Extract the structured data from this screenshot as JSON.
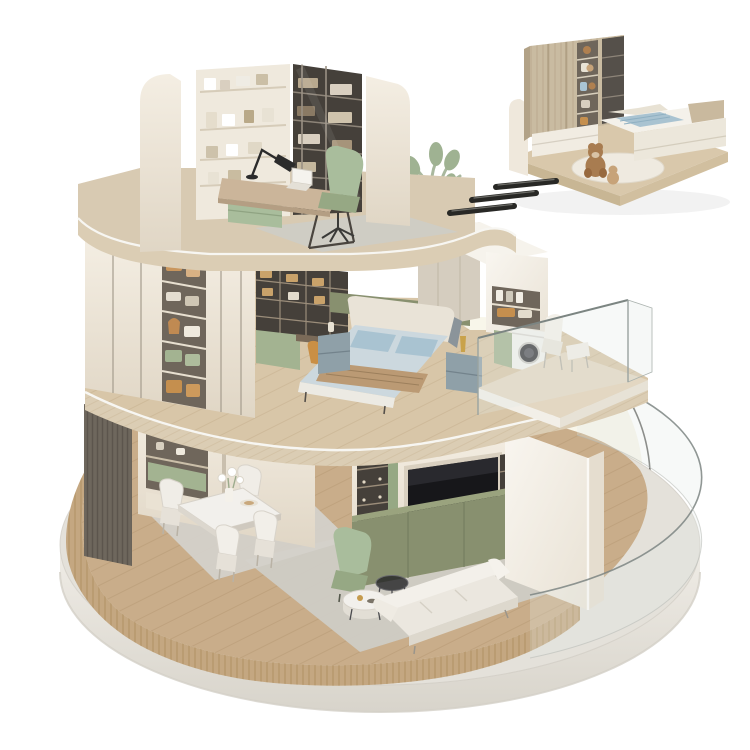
{
  "scene": {
    "type": "isometric-cutaway-render",
    "description": "Three-storey apartment cutaway standing on a round stone base, with a detached kids-bedroom detail block floating at the top right and three motion dashes linking it to the building",
    "background": "#ffffff"
  },
  "palette": {
    "stone_top": "#e4e1da",
    "stone_side": "#edeae4",
    "stone_rim": "#d3cfc7",
    "wood_floor": "#c9ad8a",
    "wood_plinth": "#c4a781",
    "travertine": "#dbcdb4",
    "trim_white": "#f7f6f2",
    "wall_cream": "#f0e9dd",
    "wall_cream_shade": "#e1d7c7",
    "wall_white": "#f6f2ec",
    "wardrobe_door": "#ece4d6",
    "recess_dark": "#6f665b",
    "shelf_dark": "#45403a",
    "bronze": "#9b8d7a",
    "olive": "#88906f",
    "olive_top": "#9aa37e",
    "sage": "#a9bd9c",
    "sage_dark": "#96a884",
    "green_cabinet": "#a3b391",
    "bed_duvet": "#ccd8de",
    "bed_pillow": "#a9c3d1",
    "throw_tan": "#bb9a74",
    "headboard_cream": "#e9e3d7",
    "slate": "#8b949a",
    "rug_gray": "#cfccc5",
    "rug_warm": "#d4d1ca",
    "tv_black": "#17171a",
    "dark_slat": "#6e675d",
    "glass_line": "#7c8582",
    "glass_fill": "rgba(225,232,230,0.28)",
    "dome": "#f8f6ea",
    "dome_edge": "#3a3a36",
    "arrow": "#282825",
    "inset_base": "#d9c8ab",
    "inset_wardrobe": "#c9bba1",
    "teddy": "#a87c50",
    "tan_chair": "#c98f45",
    "nightstand": "#8fa0a8",
    "marble_table": "#f2f0ec"
  },
  "structure": {
    "platform": {
      "name": "round-stone-base"
    },
    "floors": [
      {
        "id": "ground",
        "rooms": [
          {
            "name": "dining-area",
            "items": [
              "curved-slat-wall",
              "dark-slat-panel",
              "display-cabinet",
              "dining-table",
              "dining-chairs",
              "flower-vase",
              "area-rug"
            ]
          },
          {
            "name": "living-room",
            "items": [
              "media-wall",
              "tv-screen",
              "olive-tv-cabinet",
              "lit-display-shelves",
              "white-corner-wall",
              "white-sofa",
              "marble-coffee-table",
              "glass-side-table",
              "sage-armchair",
              "area-rug",
              "curved-glass-balustrade"
            ]
          }
        ]
      },
      {
        "id": "middle",
        "rooms": [
          {
            "name": "walk-in-wardrobe",
            "items": [
              "cream-wardrobes",
              "open-shelves-clothes",
              "storage-boxes",
              "wicker-baskets"
            ]
          },
          {
            "name": "master-bedroom",
            "items": [
              "shelf-desk-wall",
              "vanity-chair",
              "double-bed",
              "blue-bedding",
              "tan-throw",
              "nightstands",
              "padded-wall",
              "potted-plant"
            ]
          },
          {
            "name": "laundry-balcony",
            "items": [
              "laundry-tower",
              "washing-machine",
              "towel-shelves",
              "glass-railing",
              "lounge-chair",
              "ottoman"
            ]
          }
        ]
      },
      {
        "id": "top",
        "rooms": [
          {
            "name": "study",
            "items": [
              "rounded-side-walls",
              "wall-shelving",
              "glass-bookcase",
              "desk",
              "desk-lamp",
              "laptop",
              "green-desk-chair",
              "area-rug"
            ]
          }
        ]
      }
    ],
    "inset": {
      "name": "kids-bedroom-block",
      "items": [
        "wood-wardrobe",
        "toy-shelf-column",
        "drawer-chest",
        "kids-bed",
        "blue-blanket",
        "teddy-bear",
        "small-bear",
        "round-rug",
        "wood-base"
      ]
    },
    "connector": {
      "name": "motion-dashes",
      "count": 3
    }
  }
}
